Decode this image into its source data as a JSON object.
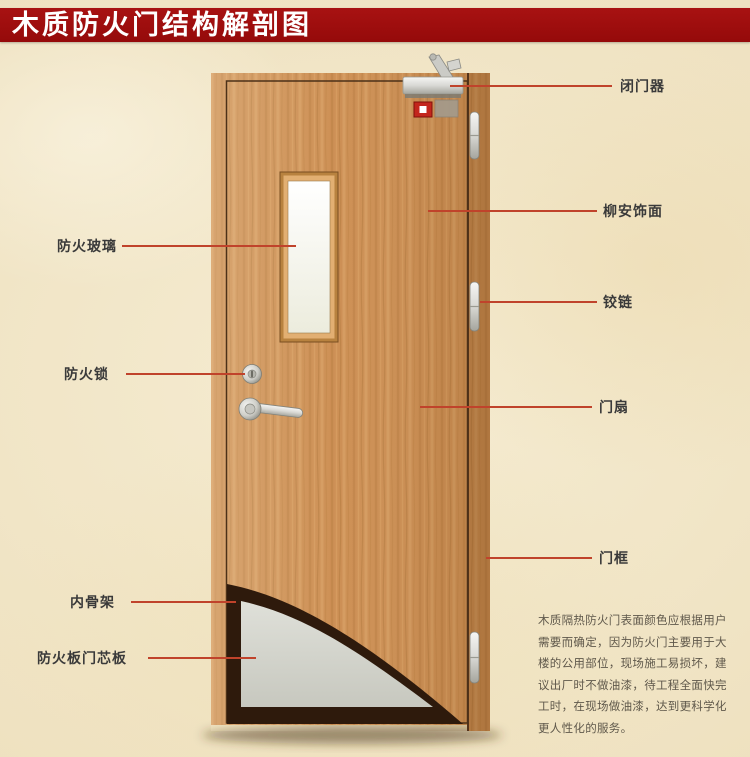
{
  "header": {
    "title": "木质防火门结构解剖图"
  },
  "labels": {
    "fire_glass": "防火玻璃",
    "fire_lock": "防火锁",
    "inner_frame": "内骨架",
    "core_board": "防火板门芯板",
    "door_closer": "闭门器",
    "veneer": "柳安饰面",
    "hinge": "铰链",
    "door_leaf": "门扇",
    "door_frame": "门框"
  },
  "description": {
    "lines": [
      "木质隔热防火门表面颜色应根据用户",
      "需要而确定，因为防火门主要用于大",
      "楼的公用部位，现场施工易损坏，建",
      "议出厂时不做油漆，待工程全面快完",
      "工时，在现场做油漆，达到更科学化",
      "更人性化的服务。"
    ]
  },
  "colors": {
    "banner_red": "#9e0c0c",
    "banner_text": "#ffffff",
    "background_beige": "#f2e7c9",
    "leader_line_red": "#c0432b",
    "door_wood": "#cd9055",
    "door_frame_gap": "#54331a",
    "inner_frame_dark": "#2e1a0c",
    "core_board_gray": "#d6d6cd",
    "glass_white": "#fbfaf2",
    "hardware_metal": "#d8d8d4",
    "alarm_red": "#c3261d",
    "label_text": "#3a3a3a",
    "description_text": "#5f584b"
  }
}
